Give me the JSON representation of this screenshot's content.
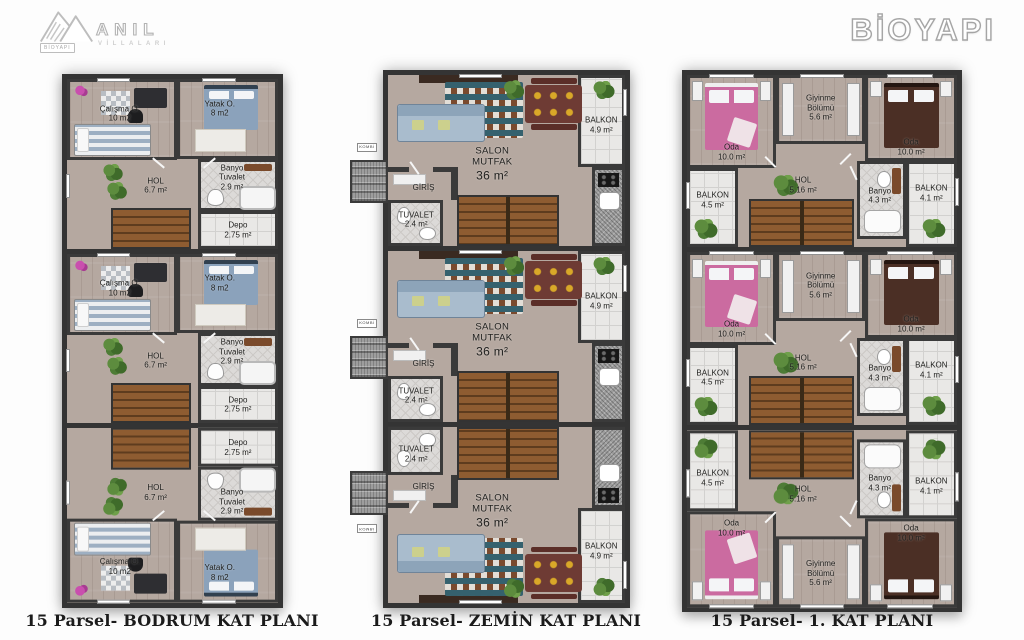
{
  "header": {
    "logo_left": {
      "brand": "ANIL",
      "subtitle": "VİLLALARI",
      "badge": "BİOYAPI"
    },
    "logo_right": {
      "brand": "BİOYAPI"
    }
  },
  "plans": {
    "bodrum": {
      "caption": "15 Parsel- BODRUM KAT PLANI",
      "rooms": {
        "calisma": {
          "name": "Çalışma O.",
          "area": "10 m2"
        },
        "yatak": {
          "name": "Yatak O.",
          "area": "8 m2"
        },
        "hol": {
          "name": "HOL",
          "area": "6.7 m²"
        },
        "banyo": {
          "name": "Banyo Tuvalet",
          "area": "2.9 m²"
        },
        "depo": {
          "name": "Depo",
          "area": "2.75 m²"
        }
      }
    },
    "zemin": {
      "caption": "15 Parsel- ZEMİN KAT PLANI",
      "rooms": {
        "salon": {
          "name": "SALON MUTFAK",
          "area": "36 m²"
        },
        "balkon": {
          "name": "BALKON",
          "area": "4.9 m²"
        },
        "giris": {
          "name": "GİRİŞ"
        },
        "tuvalet": {
          "name": "TUVALET",
          "area": "2.4 m²"
        },
        "kombi": {
          "name": "KOMBİ"
        }
      }
    },
    "kat1": {
      "caption": "15 Parsel- 1. KAT PLANI",
      "rooms": {
        "oda_left": {
          "name": "Oda",
          "area": "10.0 m²"
        },
        "oda_right": {
          "name": "Oda",
          "area": "10.0 m²"
        },
        "giyinme": {
          "name": "Giyinme Bölümü",
          "area": "5.6 m²"
        },
        "hol": {
          "name": "HOL",
          "area": "5.16 m²"
        },
        "banyo": {
          "name": "Banyo",
          "area": "4.3 m²"
        },
        "balkon_left": {
          "name": "BALKON",
          "area": "4.5 m²"
        },
        "balkon_right": {
          "name": "BALKON",
          "area": "4.1 m²"
        }
      }
    }
  }
}
